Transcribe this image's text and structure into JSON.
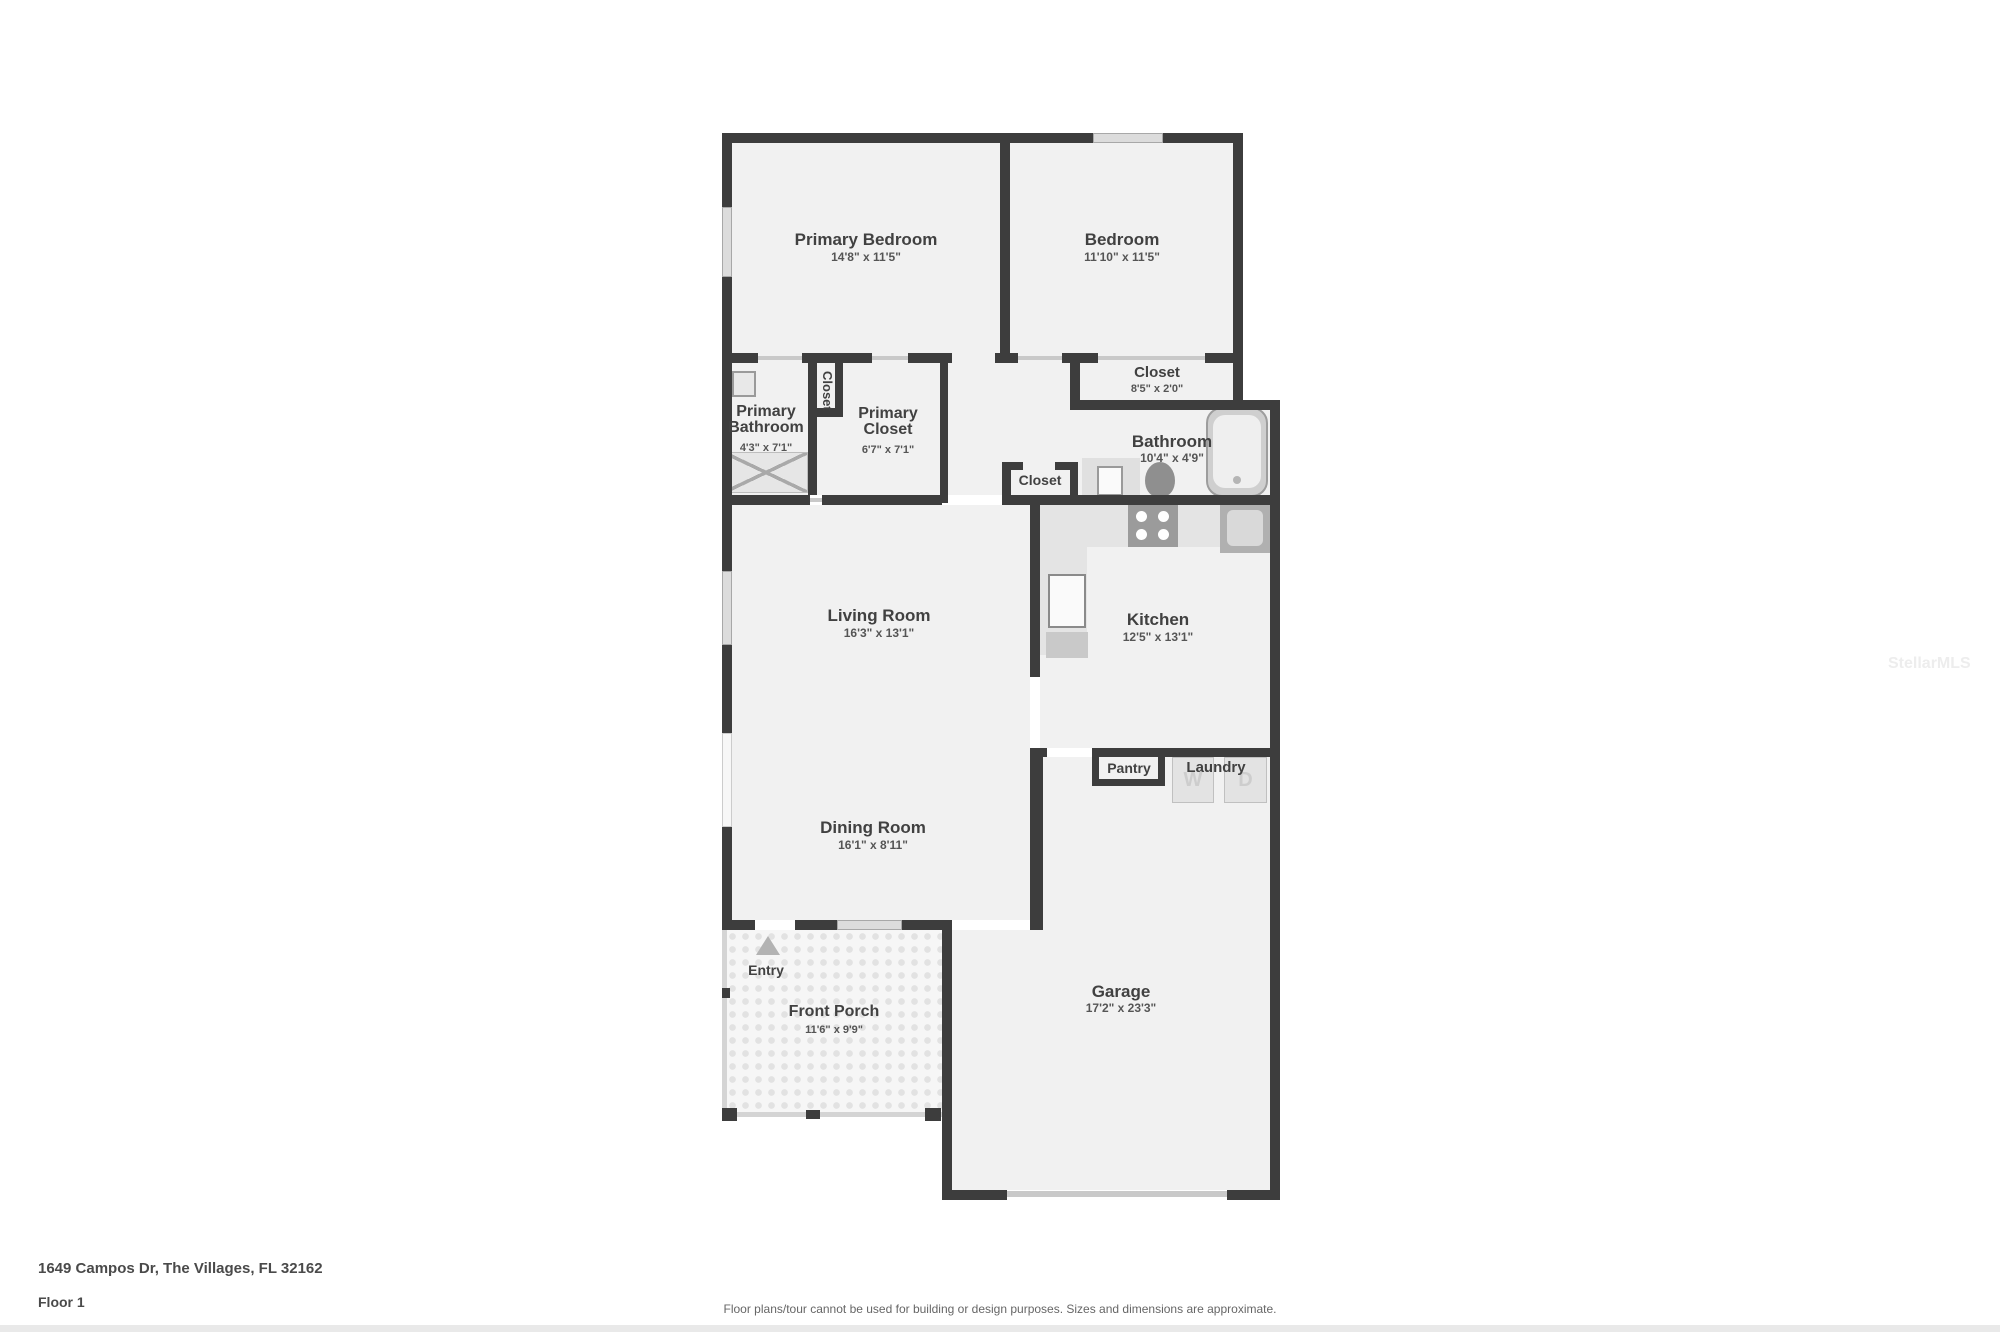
{
  "meta": {
    "address": "1649 Campos Dr, The Villages, FL 32162",
    "floor_label": "Floor 1",
    "disclaimer": "Floor plans/tour cannot be used for building or design purposes. Sizes and dimensions are approximate.",
    "watermark": "StellarMLS"
  },
  "colors": {
    "wall": "#3d3d3d",
    "floor": "#f1f1f1",
    "window": "#dcdcdc",
    "fixture_light": "#e3e3e3",
    "fixture_dark": "#9b9b9b",
    "text": "#414141"
  },
  "rooms": [
    {
      "name": "Primary Bedroom",
      "dims": "14'8\" x 11'5\""
    },
    {
      "name": "Bedroom",
      "dims": "11'10\" x 11'5\""
    },
    {
      "name": "Closet",
      "dims": "8'5\" x 2'0\""
    },
    {
      "name": "Primary Bathroom",
      "dims": "4'3\" x 7'1\""
    },
    {
      "name": "Primary Closet",
      "dims": "6'7\" x 7'1\""
    },
    {
      "name": "Bathroom",
      "dims": "10'4\" x 4'9\""
    },
    {
      "name": "Living Room",
      "dims": "16'3\" x 13'1\""
    },
    {
      "name": "Kitchen",
      "dims": "12'5\" x 13'1\""
    },
    {
      "name": "Dining Room",
      "dims": "16'1\" x 8'11\""
    },
    {
      "name": "Front Porch",
      "dims": "11'6\" x 9'9\""
    },
    {
      "name": "Garage",
      "dims": "17'2\" x 23'3\""
    }
  ],
  "labels": {
    "closet_hall": "Closet",
    "closet_nook": "Closet",
    "pantry": "Pantry",
    "laundry": "Laundry",
    "entry": "Entry",
    "washer": "W",
    "dryer": "D"
  }
}
